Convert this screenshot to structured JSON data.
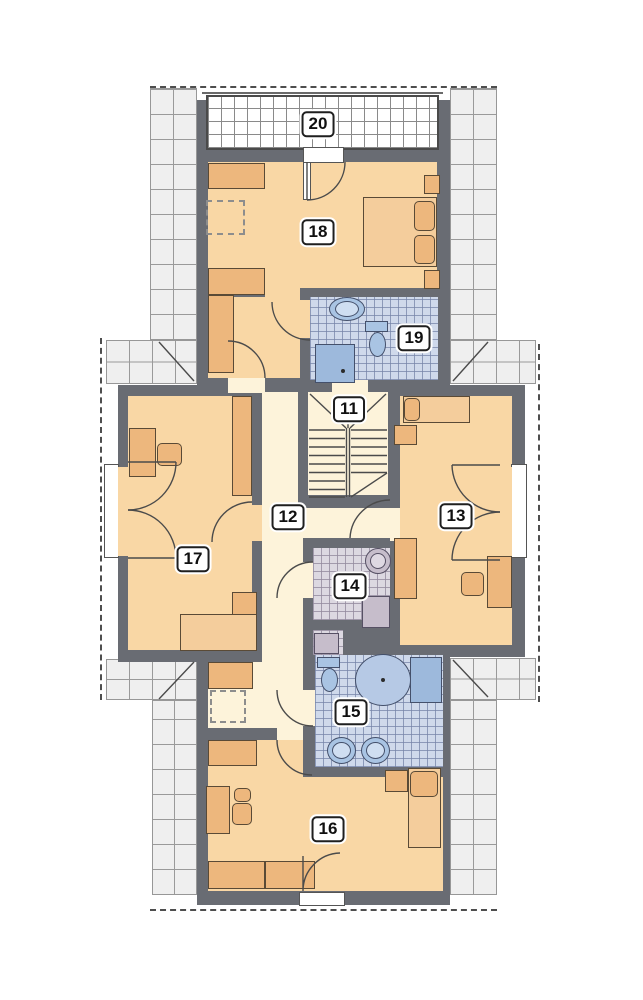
{
  "rooms": {
    "r11": {
      "number": "11"
    },
    "r12": {
      "number": "12"
    },
    "r13": {
      "number": "13"
    },
    "r14": {
      "number": "14"
    },
    "r15": {
      "number": "15"
    },
    "r16": {
      "number": "16"
    },
    "r17": {
      "number": "17"
    },
    "r18": {
      "number": "18"
    },
    "r19": {
      "number": "19"
    },
    "r20": {
      "number": "20"
    }
  },
  "palette": {
    "wall": "#696c73",
    "room_floor": "#f9d7a5",
    "hall_floor": "#fdf3da",
    "furniture": "#edb77d",
    "bath_tile_blue": "#cfd9eb",
    "bath_tile_lavender": "#dcd8e1",
    "fixture_blue": "#a9c4e3",
    "fixture_purple": "#c6bdcb",
    "roof_hatch": "#efefef"
  }
}
